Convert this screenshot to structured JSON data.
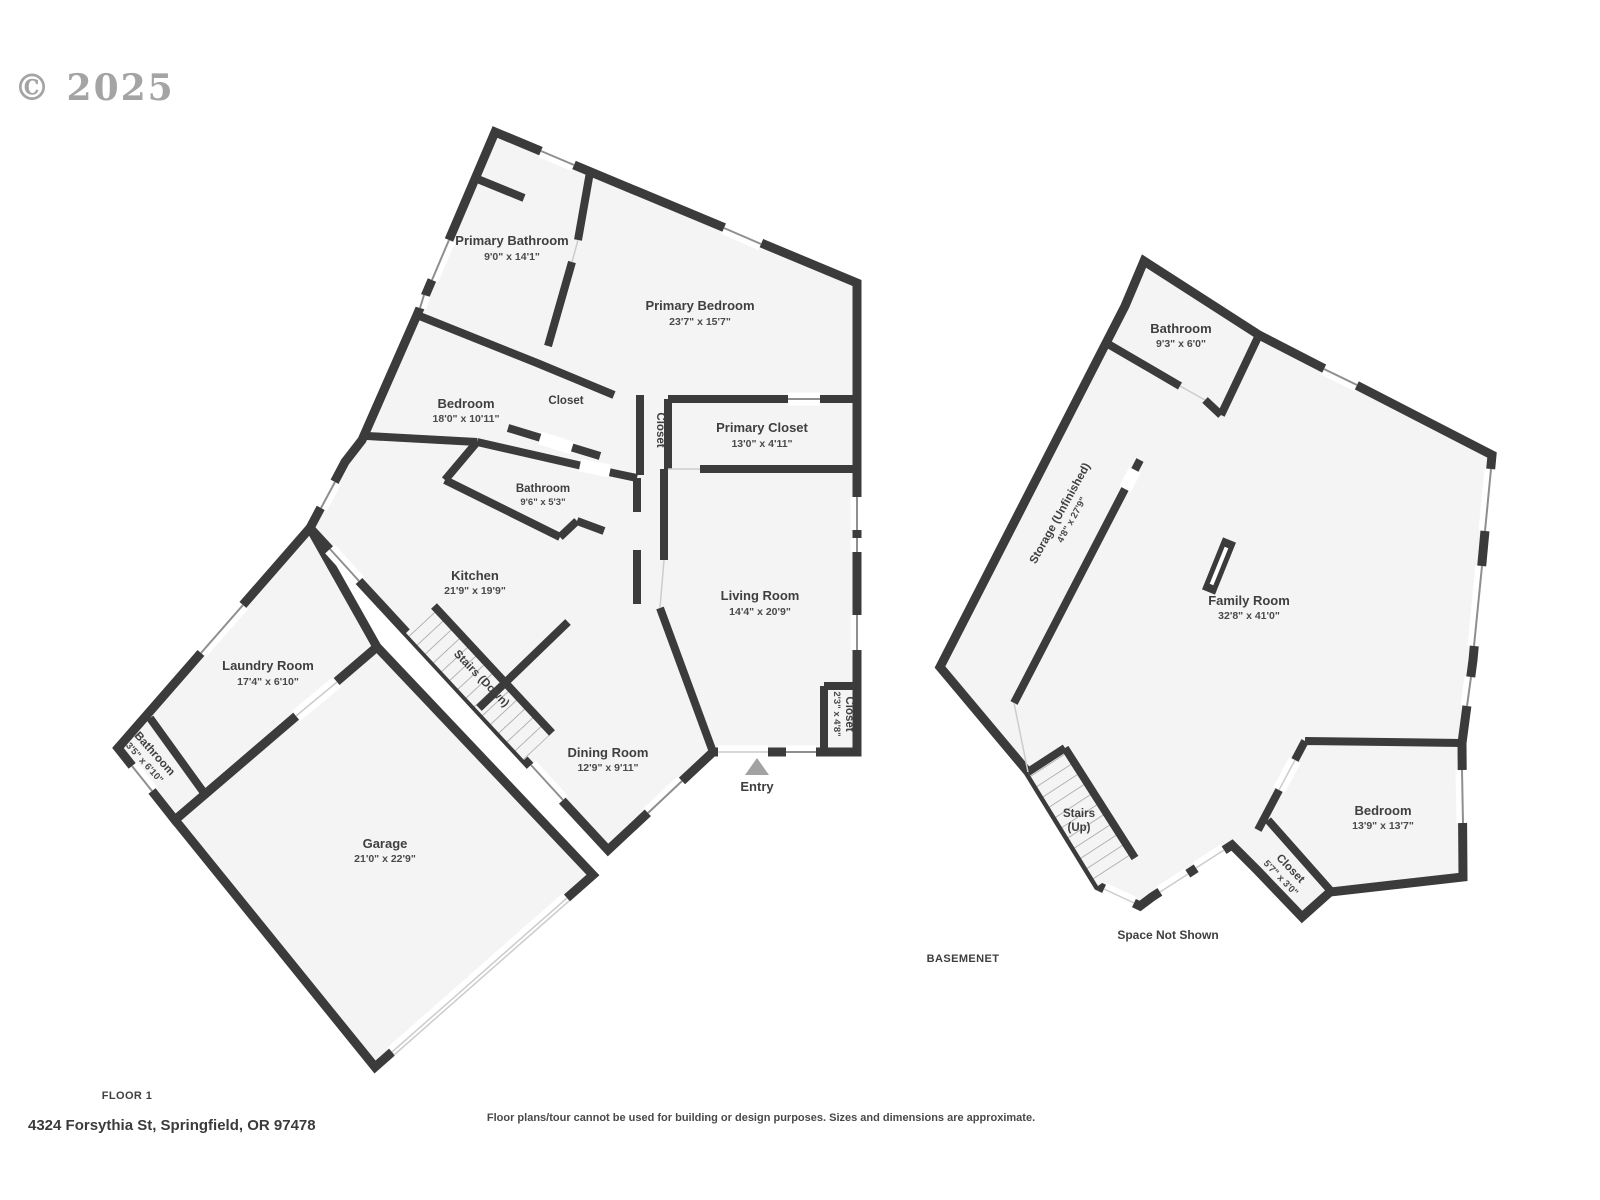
{
  "watermark": "© 2025",
  "colors": {
    "wall": "#3b3b3b",
    "floor_fill": "#f4f4f4",
    "window_line": "#8f8f8f",
    "label": "#3f3f3f"
  },
  "floor1": {
    "title": "FLOOR 1",
    "entry_label": "Entry",
    "rooms": {
      "primary_bathroom": {
        "name": "Primary Bathroom",
        "dims": "9'0\" x 14'1\""
      },
      "primary_bedroom": {
        "name": "Primary Bedroom",
        "dims": "23'7\" x 15'7\""
      },
      "bedroom": {
        "name": "Bedroom",
        "dims": "18'0\" x 10'11\""
      },
      "closet_hall": {
        "name": "Closet"
      },
      "closet_corridor": {
        "name": "Closet"
      },
      "primary_closet": {
        "name": "Primary Closet",
        "dims": "13'0\" x 4'11\""
      },
      "bathroom": {
        "name": "Bathroom",
        "dims": "9'6\" x 5'3\""
      },
      "kitchen": {
        "name": "Kitchen",
        "dims": "21'9\" x 19'9\""
      },
      "living_room": {
        "name": "Living Room",
        "dims": "14'4\" x 20'9\""
      },
      "stairs_down": {
        "name": "Stairs (Down)"
      },
      "laundry_room": {
        "name": "Laundry Room",
        "dims": "17'4\" x 6'10\""
      },
      "bathroom_small": {
        "name": "Bathroom",
        "dims": "3'5\" x 6'10\""
      },
      "garage": {
        "name": "Garage",
        "dims": "21'0\" x 22'9\""
      },
      "dining_room": {
        "name": "Dining Room",
        "dims": "12'9\" x 9'11\""
      },
      "closet_entry": {
        "name": "Closet",
        "dims": "2'3\" x 4'8\""
      }
    }
  },
  "basement": {
    "title": "BASEMENET",
    "note": "Space Not Shown",
    "rooms": {
      "bathroom": {
        "name": "Bathroom",
        "dims": "9'3\" x 6'0\""
      },
      "storage": {
        "name": "Storage (Unfinished)",
        "dims": "4'8\" x 27'9\""
      },
      "family_room": {
        "name": "Family Room",
        "dims": "32'8\" x 41'0\""
      },
      "stairs_up": {
        "name": "Stairs",
        "sub": "(Up)"
      },
      "bedroom": {
        "name": "Bedroom",
        "dims": "13'9\" x 13'7\""
      },
      "closet": {
        "name": "Closet",
        "dims": "5'7\" x 3'0\""
      }
    }
  },
  "footer": {
    "address": "4324 Forsythia St, Springfield, OR 97478",
    "disclaimer": "Floor plans/tour cannot be used for building or design purposes. Sizes and dimensions are approximate."
  }
}
